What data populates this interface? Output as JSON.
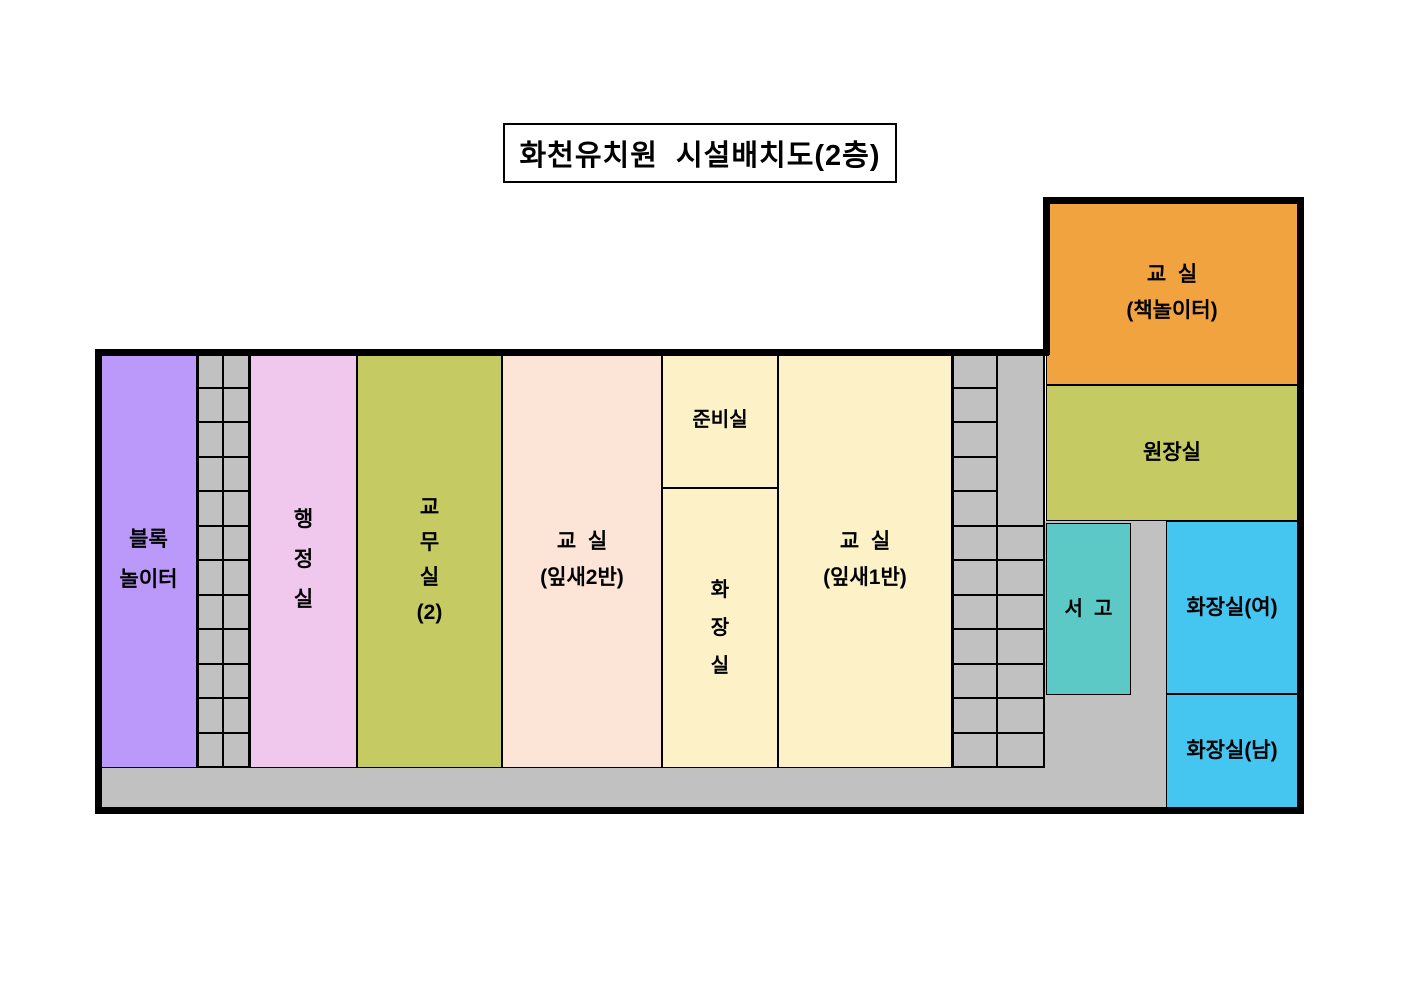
{
  "title": "화천유치원  시설배치도(2층)",
  "legend_note": "floor plan of kindergarten 2nd floor",
  "colors": {
    "wall": "#000000",
    "gray": "#C1C1C1",
    "purple": "#BB99FA",
    "pink": "#F0C8EE",
    "olive": "#C6CA62",
    "peach": "#FCE4D7",
    "light_yellow": "#FDF2C7",
    "orange": "#F1A33F",
    "teal": "#5CC9C6",
    "blue": "#45C6F0"
  },
  "rooms": [
    {
      "id": "block-playroom",
      "lines": [
        "블록",
        "놀이터"
      ],
      "color": "#BB99FA",
      "x": 100,
      "y": 352,
      "w": 97,
      "h": 416,
      "fs": 21,
      "lh": 40
    },
    {
      "id": "admin-office",
      "lines": [
        "행",
        "정",
        "실"
      ],
      "color": "#F0C8EE",
      "x": 250,
      "y": 352,
      "w": 107,
      "h": 416,
      "fs": 21,
      "lh": 40
    },
    {
      "id": "teachers-office",
      "lines": [
        "교",
        "무",
        "실",
        "(2)"
      ],
      "color": "#C6CA62",
      "x": 357,
      "y": 352,
      "w": 145,
      "h": 416,
      "fs": 21,
      "lh": 35
    },
    {
      "id": "classroom-ipsae2",
      "lines": [
        "교  실",
        "(잎새2반)"
      ],
      "color": "#FCE4D7",
      "x": 502,
      "y": 352,
      "w": 160,
      "h": 416,
      "fs": 21,
      "lh": 36
    },
    {
      "id": "prep-room",
      "lines": [
        "준비실"
      ],
      "color": "#FDF2C7",
      "x": 662,
      "y": 352,
      "w": 116,
      "h": 136,
      "fs": 20,
      "lh": 34
    },
    {
      "id": "restroom-inner",
      "lines": [
        "화",
        "장",
        "실"
      ],
      "color": "#FDF2C7",
      "x": 662,
      "y": 488,
      "w": 116,
      "h": 280,
      "fs": 20,
      "lh": 38
    },
    {
      "id": "classroom-ipsae1",
      "lines": [
        "교  실",
        "(잎새1반)"
      ],
      "color": "#FDF2C7",
      "x": 778,
      "y": 352,
      "w": 174,
      "h": 416,
      "fs": 21,
      "lh": 36
    },
    {
      "id": "classroom-book",
      "lines": [
        "교  실",
        "(책놀이터)"
      ],
      "color": "#F1A33F",
      "x": 1046,
      "y": 200,
      "w": 252,
      "h": 185,
      "fs": 21,
      "lh": 36
    },
    {
      "id": "director-office",
      "lines": [
        "원장실"
      ],
      "color": "#C6CA62",
      "x": 1046,
      "y": 385,
      "w": 252,
      "h": 136,
      "fs": 21,
      "lh": 34
    },
    {
      "id": "book-storage",
      "lines": [
        "서  고"
      ],
      "color": "#5CC9C6",
      "x": 1046,
      "y": 523,
      "w": 85,
      "h": 172,
      "fs": 20,
      "lh": 34
    },
    {
      "id": "restroom-women",
      "lines": [
        "화장실(여)"
      ],
      "color": "#45C6F0",
      "x": 1166,
      "y": 521,
      "w": 132,
      "h": 173,
      "fs": 21,
      "lh": 34
    },
    {
      "id": "restroom-men",
      "lines": [
        "화장실(남)"
      ],
      "color": "#45C6F0",
      "x": 1166,
      "y": 694,
      "w": 132,
      "h": 114,
      "fs": 21,
      "lh": 34
    }
  ],
  "stair_blocks": [
    {
      "id": "stairs-left",
      "x": 197,
      "y": 352,
      "w": 53,
      "h": 416,
      "rows": 12,
      "cols": [
        26,
        27
      ],
      "merge_top_rows_col2": 0
    },
    {
      "id": "stairs-right",
      "x": 952,
      "y": 352,
      "w": 93,
      "h": 416,
      "rows": 12,
      "cols": [
        45,
        48
      ],
      "merge_top_rows_col2": 5
    }
  ],
  "gray_areas": [
    {
      "id": "corridor-bottom",
      "x": 101,
      "y": 768,
      "w": 1065,
      "h": 40
    },
    {
      "id": "corridor-right",
      "x": 1045,
      "y": 521,
      "w": 121,
      "h": 287
    }
  ],
  "walls": [
    {
      "id": "outer-wall-left",
      "x": 95,
      "y": 349,
      "w": 7,
      "h": 465
    },
    {
      "id": "outer-wall-top-main",
      "x": 95,
      "y": 349,
      "w": 954,
      "h": 7
    },
    {
      "id": "outer-wall-wing-left",
      "x": 1043,
      "y": 197,
      "w": 7,
      "h": 158
    },
    {
      "id": "outer-wall-wing-top",
      "x": 1043,
      "y": 197,
      "w": 261,
      "h": 7
    },
    {
      "id": "outer-wall-right",
      "x": 1297,
      "y": 197,
      "w": 7,
      "h": 617
    },
    {
      "id": "outer-wall-bottom",
      "x": 95,
      "y": 807,
      "w": 1209,
      "h": 7
    }
  ]
}
